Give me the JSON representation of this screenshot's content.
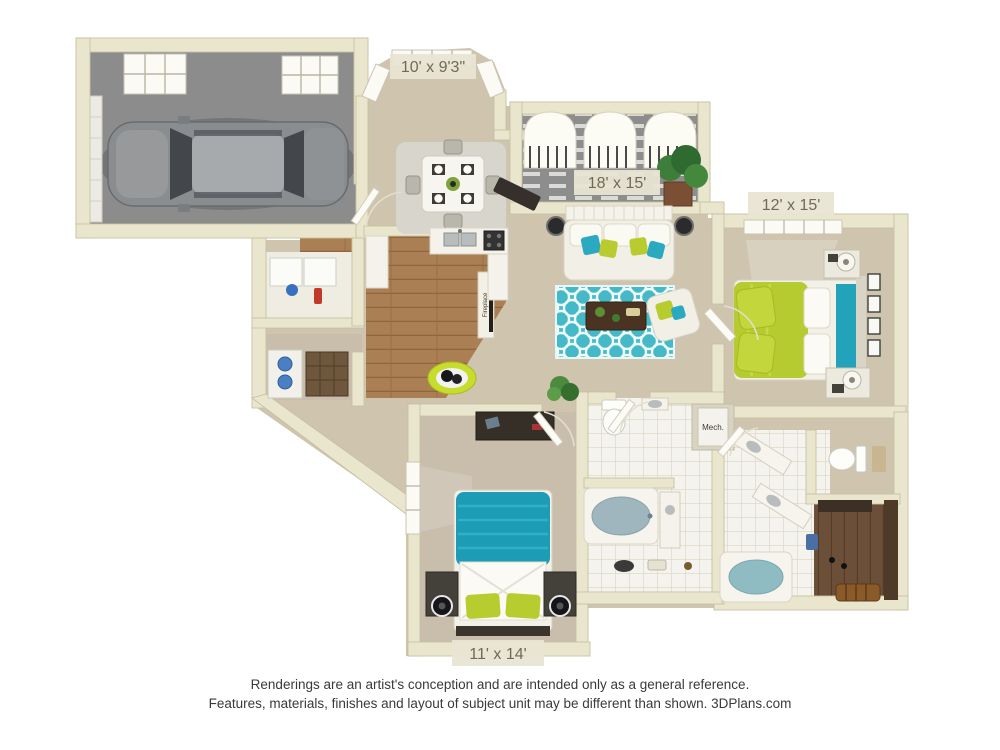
{
  "floor_plan": {
    "room_labels": [
      {
        "id": "breakfast-nook",
        "dimension": "10' x 9'3\""
      },
      {
        "id": "living-room",
        "dimension": "18' x 15'"
      },
      {
        "id": "master-bedroom",
        "dimension": "12' x 15'"
      },
      {
        "id": "bedroom-2",
        "dimension": "11' x 14'"
      }
    ],
    "text_annotations": {
      "fireplace": "Fireplace",
      "mechanical": "Mech."
    }
  },
  "footer": {
    "line1": "Renderings are an artist's conception and are intended only as a general reference.",
    "line2": "Features, materials, finishes and layout of subject unit may be different than shown. 3DPlans.com"
  },
  "colors": {
    "wall_cream": "#eae6ce",
    "wall_edge": "#c6c1a3",
    "floor_tan": "#cfc4ae",
    "floor_wood": "#aa7f53",
    "garage_concrete": "#8c8c8c",
    "tile_white": "#f5f3ed",
    "closet_wood": "#6b4f38",
    "accent_lime": "#b6cb2f",
    "accent_teal": "#1e9cb5",
    "rug_teal": "#45b9c8",
    "tub_water": "#9fb6bf",
    "label_bg": "#e9e5d3",
    "label_text": "#6f6a58",
    "footer_text": "#3a3a3a"
  }
}
